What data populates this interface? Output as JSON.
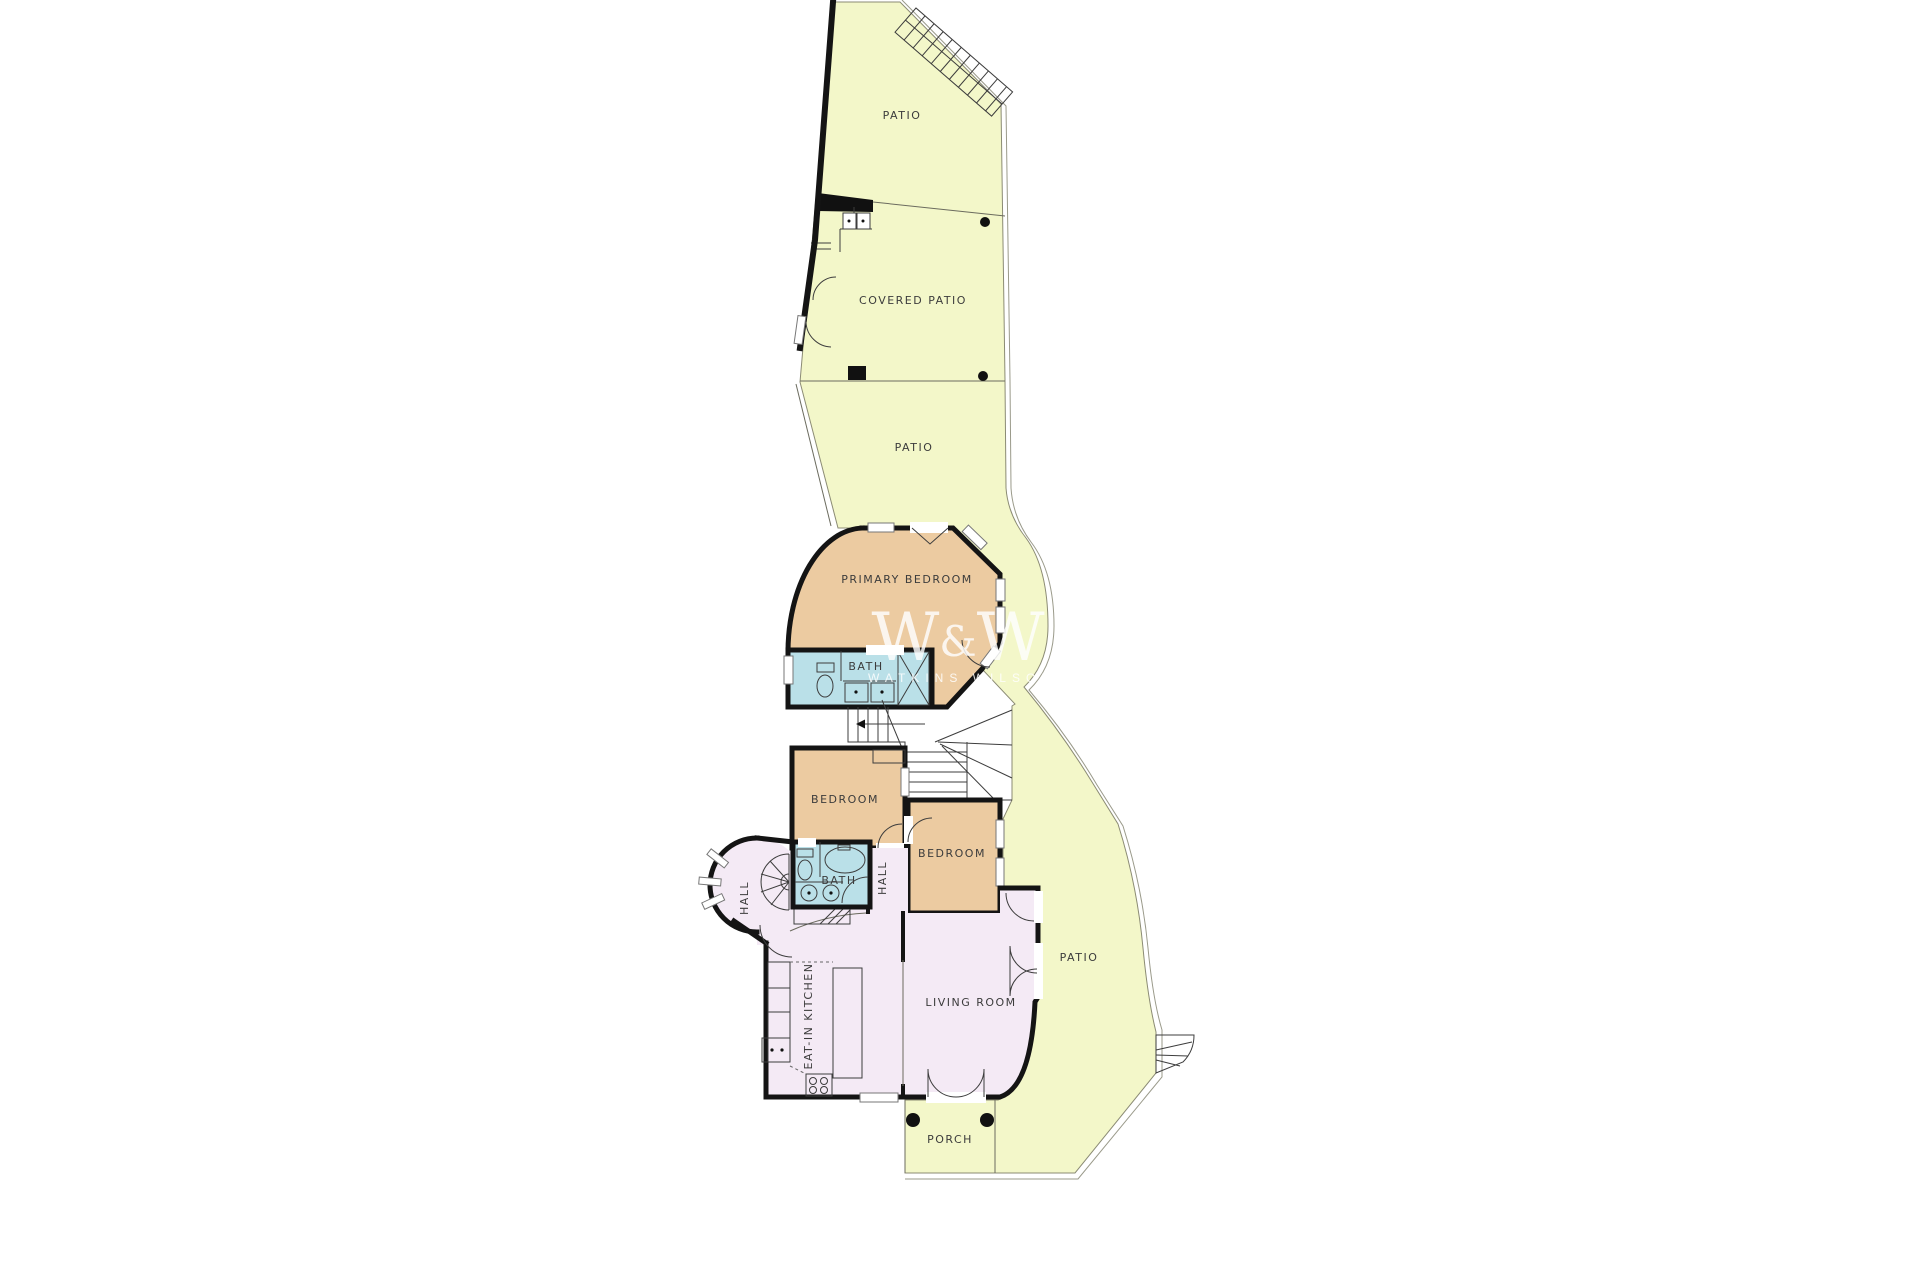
{
  "plan": {
    "title": "Floor plan",
    "labels": {
      "patio_top": "PATIO",
      "covered_patio": "COVERED PATIO",
      "patio_mid": "PATIO",
      "primary_bedroom": "PRIMARY BEDROOM",
      "bath_primary": "BATH",
      "bedroom_1": "BEDROOM",
      "bedroom_2": "BEDROOM",
      "bath_2": "BATH",
      "hall_center": "HALL",
      "hall_round": "HALL",
      "kitchen": "EAT-IN KITCHEN",
      "living_room": "LIVING ROOM",
      "patio_right": "PATIO",
      "porch": "PORCH"
    },
    "watermark": {
      "logo_w1": "W",
      "logo_amp": "&",
      "logo_w2": "W",
      "brand": "WATKINS WILSON"
    },
    "colors": {
      "outdoor": "#f3f7c9",
      "bedroom": "#eccba1",
      "bath": "#bae0e8",
      "living": "#f4eaf5",
      "wall": "#141414",
      "label": "#3c3c3c",
      "watermark": "#ffffff"
    }
  }
}
